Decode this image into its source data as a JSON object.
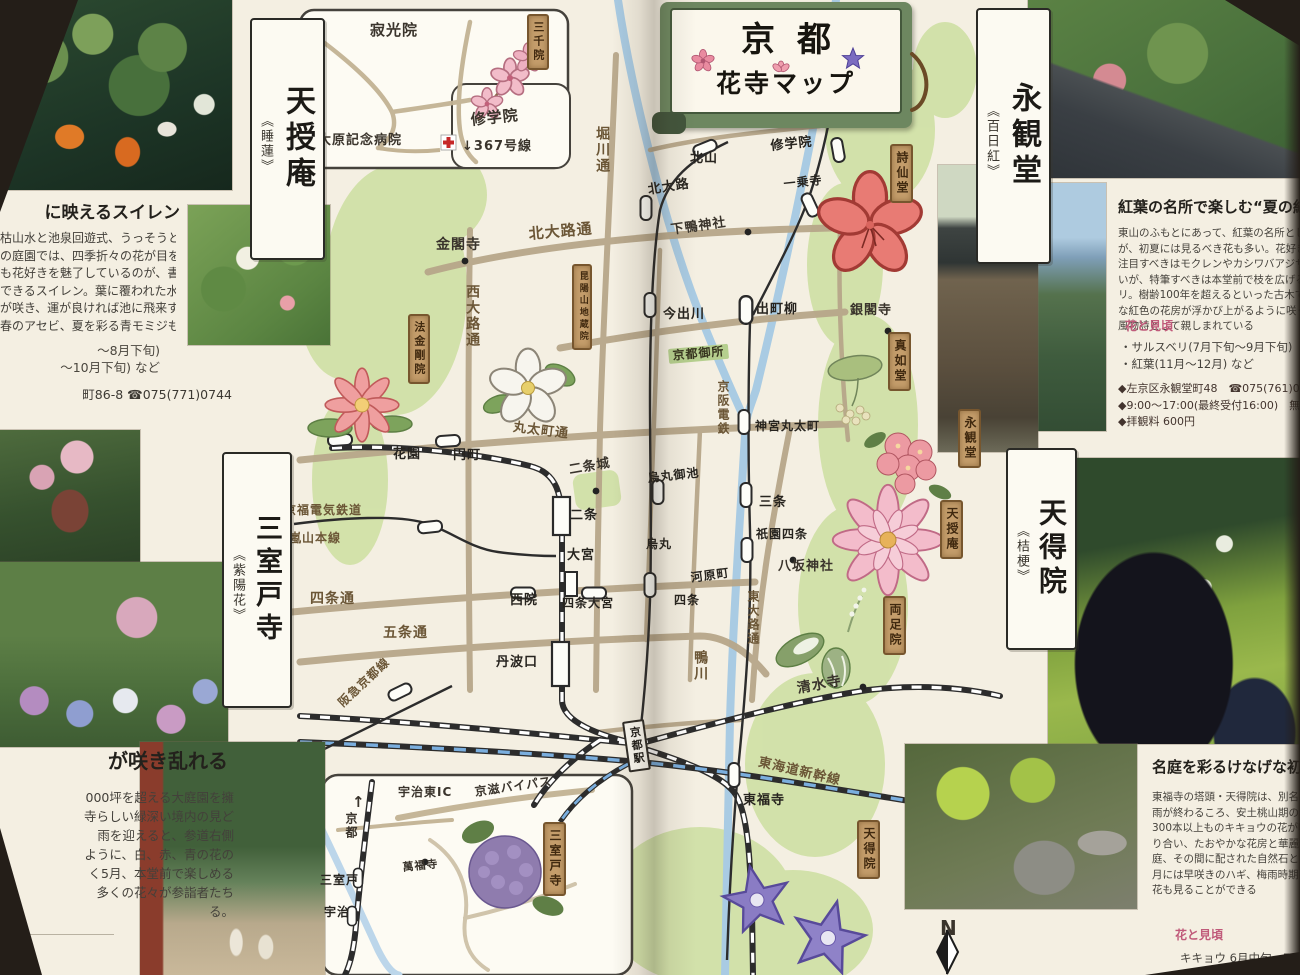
{
  "banner": {
    "title_top": "京都",
    "title_bottom": "花寺マップ"
  },
  "left_page": {
    "tenjuan": {
      "plaque_name": "天授庵",
      "plaque_flower": "《睡蓮》",
      "article": {
        "heading": "に映えるスイレン",
        "body_lines": [
          "枯山水と池泉回遊式、うっそうとした緑が",
          "の庭園では、四季折々の花が目を楽しませ",
          "も花好きを魅了しているのが、書院南庭の",
          "できるスイレン。葉に覆われた水面に、点々",
          "が咲き、運が良ければ池に飛来するサギ",
          "春のアセビ、夏を彩る青モミジもおすす"
        ],
        "season_lines": [
          "〜8月下旬)",
          "〜10月下旬) など"
        ],
        "contact": "町86-8  ☎075(771)0744"
      }
    },
    "mimurotoji": {
      "plaque_name": "三室戸寺",
      "plaque_flower": "《紫陽花》",
      "article": {
        "heading": "が咲き乱れる",
        "body_lines": [
          "000坪を超える大庭園を擁",
          "寺らしい緑深い境内の見ど",
          "雨を迎えると、参道右側",
          "ように、白、赤、青の花の",
          "く5月、本堂前で楽しめる",
          "多くの花々が参詣者たち",
          "る。"
        ]
      }
    }
  },
  "right_page": {
    "eikando": {
      "plaque_name": "永観堂",
      "plaque_flower": "《百日紅》",
      "article": {
        "heading": "紅葉の名所で楽しむ“夏の紅”",
        "body_lines": [
          "東山のふもとにあって、紅葉の名所として知られる",
          "が、初夏には見るべき花も多い。花好きなら",
          "注目すべきはモクレンやカシワバアジサイ、美し",
          "いが、特筆すべきは本堂前で枝を広げるサルスベ",
          "リ。樹齢100年を超えるといった古木で、鮮やか",
          "な紅色の花房が浮かび上がるように咲くさまは、",
          "風物詩として親しまれている"
        ],
        "season_tag": "花と見頃",
        "bullets": [
          "・サルスベリ(7月下旬〜9月下旬)",
          "・紅葉(11月〜12月) など"
        ],
        "info_lines": [
          "◆左京区永観堂町48　☎075(761)0007",
          "◆9:00〜17:00(最終受付16:00)　無休",
          "◆拝観料 600円"
        ]
      }
    },
    "tentokuin": {
      "plaque_name": "天得院",
      "plaque_flower": "《桔梗》",
      "article": {
        "heading": "名庭を彩るけなげな初夏",
        "body_lines": [
          "東福寺の塔頭・天得院は、別名“桔梗",
          "雨が終わるころ、安土桃山期の作と",
          "300本以上ものキキョウの花が咲",
          "り合い、たおやかな花房と華麗な",
          "庭、その間に配された自然石と絶",
          "月には早咲きのハギ、梅雨時期の",
          "花も見ることができる"
        ],
        "season_tag": "花と見頃",
        "bullets": [
          "キキョウ 6月中旬〜7月上"
        ]
      }
    }
  },
  "map": {
    "labels": [
      {
        "t": "堀川通",
        "x": 594,
        "y": 126,
        "type": "road",
        "v": 1,
        "s": 14
      },
      {
        "t": "北大路通",
        "x": 528,
        "y": 226,
        "type": "road",
        "s": 15,
        "r": -5
      },
      {
        "t": "西大路通",
        "x": 464,
        "y": 284,
        "type": "road",
        "v": 1,
        "s": 14
      },
      {
        "t": "丸太町通",
        "x": 514,
        "y": 421,
        "type": "road",
        "s": 13,
        "r": 7
      },
      {
        "t": "四条通",
        "x": 310,
        "y": 592,
        "type": "road",
        "s": 14
      },
      {
        "t": "五条通",
        "x": 383,
        "y": 626,
        "type": "road",
        "s": 14
      },
      {
        "t": "東大路通",
        "x": 746,
        "y": 590,
        "type": "road",
        "v": 1,
        "s": 12
      },
      {
        "t": "鴨川",
        "x": 692,
        "y": 650,
        "type": "road",
        "v": 1,
        "s": 14
      },
      {
        "t": "京阪電鉄",
        "x": 716,
        "y": 380,
        "type": "road",
        "v": 1,
        "s": 12
      },
      {
        "t": "京福電気鉄道",
        "x": 284,
        "y": 504,
        "type": "road",
        "s": 12
      },
      {
        "t": "嵐山本線",
        "x": 289,
        "y": 532,
        "type": "road",
        "s": 12
      },
      {
        "t": "阪急京都線",
        "x": 336,
        "y": 700,
        "type": "road",
        "s": 12,
        "r": -43
      },
      {
        "t": "東海道新幹線",
        "x": 760,
        "y": 756,
        "type": "road",
        "s": 13,
        "r": 13
      },
      {
        "t": "北山",
        "x": 690,
        "y": 152,
        "type": "sta",
        "s": 13
      },
      {
        "t": "修学院",
        "x": 770,
        "y": 140,
        "type": "sta",
        "s": 13,
        "r": -6
      },
      {
        "t": "北大路",
        "x": 647,
        "y": 184,
        "type": "sta",
        "s": 13,
        "r": -9
      },
      {
        "t": "一乗寺",
        "x": 783,
        "y": 178,
        "type": "sta",
        "s": 12,
        "r": -6
      },
      {
        "t": "今出川",
        "x": 663,
        "y": 308,
        "type": "sta",
        "s": 13
      },
      {
        "t": "出町柳",
        "x": 756,
        "y": 303,
        "type": "sta",
        "s": 13
      },
      {
        "t": "神宮丸太町",
        "x": 755,
        "y": 420,
        "type": "sta",
        "s": 12
      },
      {
        "t": "烏丸御池",
        "x": 647,
        "y": 472,
        "type": "sta",
        "s": 12,
        "r": -6
      },
      {
        "t": "三条",
        "x": 759,
        "y": 496,
        "type": "sta",
        "s": 13
      },
      {
        "t": "祇園四条",
        "x": 756,
        "y": 528,
        "type": "sta",
        "s": 12
      },
      {
        "t": "烏丸",
        "x": 646,
        "y": 538,
        "type": "sta",
        "s": 12
      },
      {
        "t": "河原町",
        "x": 690,
        "y": 572,
        "type": "sta",
        "s": 12,
        "r": -8
      },
      {
        "t": "四条",
        "x": 674,
        "y": 594,
        "type": "sta",
        "s": 12
      },
      {
        "t": "西院",
        "x": 510,
        "y": 594,
        "type": "sta",
        "s": 13
      },
      {
        "t": "四条大宮",
        "x": 562,
        "y": 597,
        "type": "sta",
        "s": 12
      },
      {
        "t": "大宮",
        "x": 567,
        "y": 549,
        "type": "sta",
        "s": 13
      },
      {
        "t": "二条",
        "x": 570,
        "y": 509,
        "type": "sta",
        "s": 13
      },
      {
        "t": "花園",
        "x": 393,
        "y": 448,
        "type": "sta",
        "s": 13
      },
      {
        "t": "円町",
        "x": 453,
        "y": 449,
        "type": "sta",
        "s": 13
      },
      {
        "t": "丹波口",
        "x": 496,
        "y": 656,
        "type": "sta",
        "s": 13
      },
      {
        "t": "東福寺",
        "x": 743,
        "y": 794,
        "type": "sta",
        "s": 13
      },
      {
        "t": "京都駅",
        "x": 622,
        "y": 722,
        "type": "bigsta",
        "s": 11,
        "r": -8
      },
      {
        "t": "金閣寺",
        "x": 436,
        "y": 238,
        "type": "place",
        "s": 14
      },
      {
        "t": "下鴨神社",
        "x": 670,
        "y": 224,
        "type": "place",
        "s": 13,
        "r": -8
      },
      {
        "t": "銀閣寺",
        "x": 850,
        "y": 304,
        "type": "place",
        "s": 13
      },
      {
        "t": "二条城",
        "x": 568,
        "y": 464,
        "type": "place",
        "s": 13,
        "r": -10
      },
      {
        "t": "八坂神社",
        "x": 778,
        "y": 560,
        "type": "place",
        "s": 13
      },
      {
        "t": "清水寺",
        "x": 796,
        "y": 682,
        "type": "place",
        "s": 14,
        "r": -10
      },
      {
        "t": "京都御所",
        "x": 668,
        "y": 349,
        "type": "gtag",
        "s": 12,
        "r": -5
      },
      {
        "t": "寂光院",
        "x": 370,
        "y": 22,
        "type": "place",
        "s": 15
      },
      {
        "t": "大原記念病院",
        "x": 318,
        "y": 134,
        "type": "place",
        "s": 13
      },
      {
        "t": "修学院",
        "x": 470,
        "y": 112,
        "type": "place",
        "s": 15,
        "r": -6
      },
      {
        "t": "↓367号線",
        "x": 462,
        "y": 140,
        "type": "place",
        "s": 13
      },
      {
        "t": "宇治東IC",
        "x": 398,
        "y": 786,
        "type": "place",
        "s": 12
      },
      {
        "t": "京滋バイパス",
        "x": 474,
        "y": 786,
        "type": "place",
        "s": 12,
        "r": -8
      },
      {
        "t": "↑",
        "x": 352,
        "y": 794,
        "type": "place",
        "s": 15
      },
      {
        "t": "京都",
        "x": 344,
        "y": 812,
        "type": "place",
        "v": 1,
        "s": 12
      },
      {
        "t": "三室戸",
        "x": 320,
        "y": 874,
        "type": "sta",
        "s": 12
      },
      {
        "t": "宇治",
        "x": 324,
        "y": 906,
        "type": "sta",
        "s": 12
      },
      {
        "t": "萬福寺",
        "x": 402,
        "y": 862,
        "type": "place",
        "s": 11,
        "r": -6
      },
      {
        "t": "N",
        "x": 940,
        "y": 918,
        "type": "place",
        "s": 20
      },
      {
        "t": "三千院",
        "x": 527,
        "y": 14,
        "type": "plaque",
        "s": 11
      },
      {
        "t": "法金剛院",
        "x": 408,
        "y": 314,
        "type": "plaque",
        "s": 11
      },
      {
        "t": "昆陽山地蔵院",
        "x": 572,
        "y": 264,
        "type": "plaque",
        "s": 9
      },
      {
        "t": "詩仙堂",
        "x": 890,
        "y": 144,
        "type": "plaque",
        "s": 12
      },
      {
        "t": "真如堂",
        "x": 888,
        "y": 332,
        "type": "plaque",
        "s": 12
      },
      {
        "t": "永観堂",
        "x": 958,
        "y": 409,
        "type": "plaque",
        "s": 12
      },
      {
        "t": "天授庵",
        "x": 940,
        "y": 500,
        "type": "plaque",
        "s": 12
      },
      {
        "t": "両足院",
        "x": 883,
        "y": 596,
        "type": "plaque",
        "s": 12
      },
      {
        "t": "天得院",
        "x": 857,
        "y": 820,
        "type": "plaque",
        "s": 12
      },
      {
        "t": "三室戸寺",
        "x": 543,
        "y": 822,
        "type": "plaque",
        "s": 12
      }
    ]
  },
  "colors": {
    "accent_pink": "#c05a7a",
    "plaque_brown": "#c49d6b",
    "map_green": "#cfe0a4",
    "road_tan": "#b7a78a",
    "river_blue": "#a9cbe3"
  }
}
